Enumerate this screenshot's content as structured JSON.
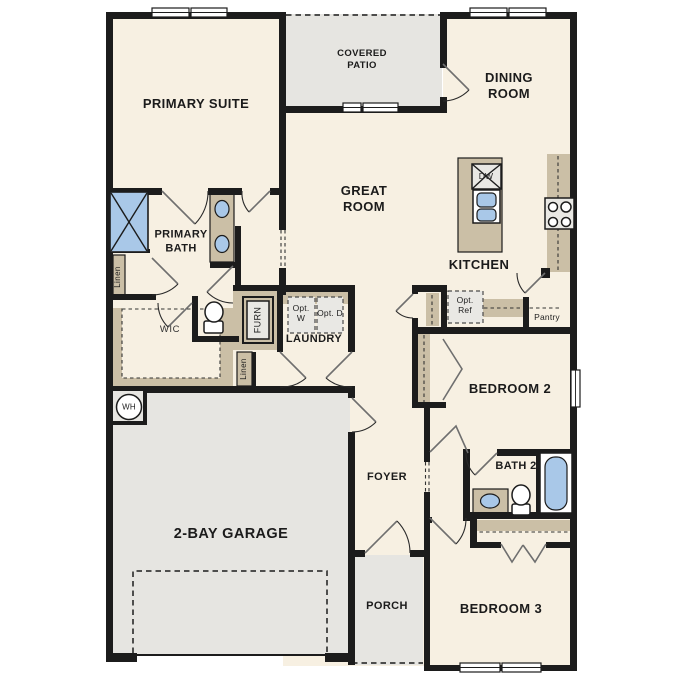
{
  "floorplan": {
    "rooms": {
      "primary_suite": "PRIMARY SUITE",
      "covered_patio": "COVERED PATIO",
      "dining_room": "DINING ROOM",
      "great_room": "GREAT ROOM",
      "kitchen": "KITCHEN",
      "primary_bath": "PRIMARY BATH",
      "wic": "WIC",
      "laundry": "LAUNDRY",
      "foyer": "FOYER",
      "garage": "2-BAY GARAGE",
      "porch": "PORCH",
      "bedroom_2": "BEDROOM 2",
      "bedroom_3": "BEDROOM 3",
      "bath_2": "BATH 2",
      "pantry": "Pantry"
    },
    "labels": {
      "linen_bath": "Linen",
      "linen_hall": "Linen",
      "furnace": "FURN",
      "water_heater": "WH",
      "dishwasher": "DW",
      "opt_washer": "Opt. W",
      "opt_dryer": "Opt. D",
      "opt_fridge": "Opt. Ref"
    },
    "colors": {
      "wall": "#1c1c1c",
      "room_fill": "#f7f0e2",
      "outdoor_fill": "#e6e5e1",
      "cabinet_fill": "#cbbfa6",
      "fixture_blue": "#a9c8e8",
      "appliance_fill": "#e9e8e4"
    }
  }
}
